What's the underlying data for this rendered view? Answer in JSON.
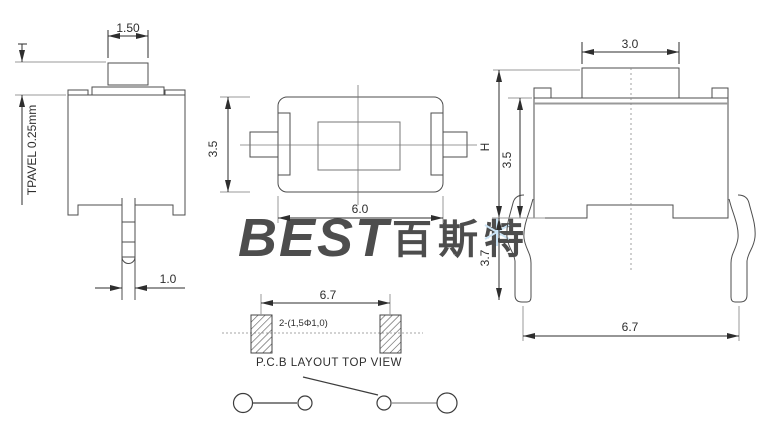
{
  "watermark": {
    "logo": "BEST",
    "cjk": "百斯特"
  },
  "side_view": {
    "knob_width": "1.50",
    "travel_label": "TPAVEL 0.25mm",
    "pin_width": "1.0"
  },
  "top_view": {
    "body_height": "3.5",
    "body_width": "6.0"
  },
  "front_view": {
    "knob_width": "3.0",
    "height_label": "H",
    "body_height": "3.5",
    "leg_length": "3.7",
    "leg_span": "6.7"
  },
  "pcb_view": {
    "pad_pitch": "6.7",
    "hole_spec": "2-(1,5Φ1,0)",
    "caption": "P.C.B LAYOUT TOP VIEW"
  },
  "colors": {
    "outline": "#4d4d4d",
    "dimension": "#2e2e2e",
    "light_gray": "#999999",
    "watermark_blue": "#b6d9f2",
    "background": "#ffffff"
  }
}
